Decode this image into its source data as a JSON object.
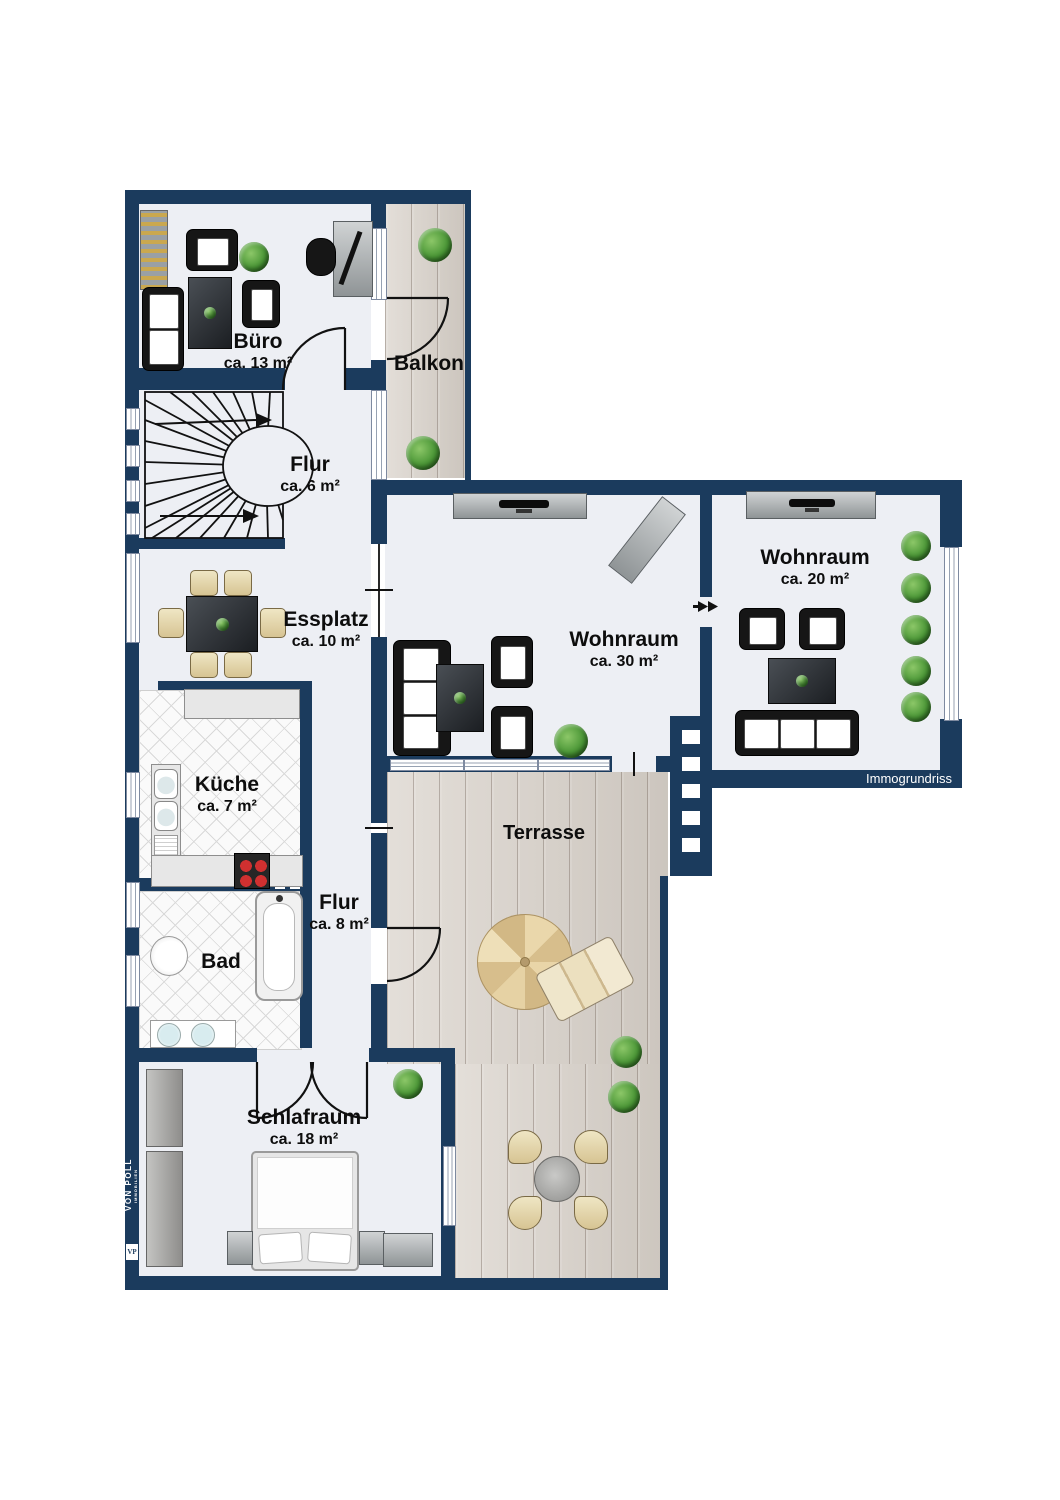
{
  "brand": {
    "name": "VON POLL",
    "subtitle": "IMMOBILIEN",
    "badge": "VP"
  },
  "watermark": "Immogrundriss",
  "colors": {
    "wall": "#1b3b5d",
    "floor": "#edeff4",
    "wood": "#d9d2ca",
    "tile": "#fafafa",
    "plant": "#4a9636",
    "chair_beige": "#e3d4a4",
    "burner_red": "#d03030",
    "label_text": "#0d0d0d",
    "watermark_text": "#ffffff"
  },
  "rooms": {
    "buero": {
      "name": "Büro",
      "area": "ca. 13 m²"
    },
    "balkon": {
      "name": "Balkon"
    },
    "flur_treppe": {
      "name": "Flur",
      "area": "ca. 6 m²"
    },
    "essplatz": {
      "name": "Essplatz",
      "area": "ca. 10 m²"
    },
    "kueche": {
      "name": "Küche",
      "area": "ca. 7 m²"
    },
    "bad": {
      "name": "Bad"
    },
    "flur_unten": {
      "name": "Flur",
      "area": "ca. 8 m²"
    },
    "schlafraum": {
      "name": "Schlafraum",
      "area": "ca. 18 m²"
    },
    "wohnraum_gross": {
      "name": "Wohnraum",
      "area": "ca. 30 m²"
    },
    "wohnraum_klein": {
      "name": "Wohnraum",
      "area": "ca. 20 m²"
    },
    "terrasse": {
      "name": "Terrasse"
    }
  },
  "icons": {
    "plant-icon": "green shrub circle",
    "stairs-icon": "winder staircase with walk-line arrows",
    "door-arc-icon": "quarter-circle swing door",
    "sliding-door-icon": "double arrow",
    "window-icon": "white glazing strip in wall",
    "sofa-icon": "black sofa with white cushions",
    "armchair-icon": "black armchair with white cushion",
    "dining-table-icon": "dark table with six beige chairs",
    "tv-sideboard-icon": "grey board with black TV",
    "desk-icon": "grey desk with monitor and chair",
    "bookshelf-icon": "shelf with books",
    "kitchen-counter-icon": "U-shaped worktop",
    "stove-icon": "cooktop with four red burners",
    "sink-icon": "double kitchen sink",
    "bathtub-icon": "bathtub with faucet",
    "toilet-icon": "WC oval",
    "washbasin-icon": "double vanity basins",
    "bed-icon": "double bed with pillows and nightstands",
    "wardrobe-icon": "grey closet",
    "parasol-icon": "eight-segment umbrella",
    "sun-lounger-icon": "beige lounger",
    "terrace-table-icon": "round table with four chairs"
  }
}
